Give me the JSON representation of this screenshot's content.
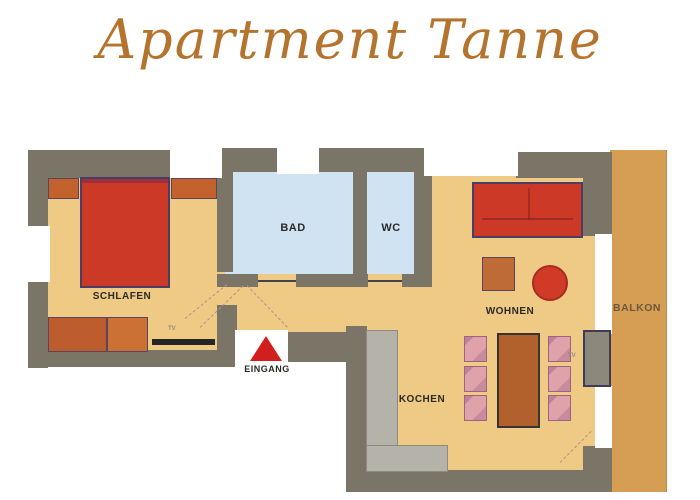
{
  "title": "Apartment Tanne",
  "floorplan": {
    "rooms": {
      "schlafen": "SCHLAFEN",
      "bad": "BAD",
      "wc": "WC",
      "wohnen": "WOHNEN",
      "kochen": "KOCHEN",
      "balkon": "BALKON"
    },
    "entrance_label": "EINGANG",
    "tv_bedroom": "TV",
    "tv_living": "TV"
  },
  "colors": {
    "title_text": "#b5742e",
    "wall": "#7b7568",
    "floor": "#eeca85",
    "balcony_floor": "#d69d55",
    "bath_floor": "#cfe3f2",
    "furniture_red": "#cc3a27",
    "furniture_orange": "#c4622d",
    "dining_table_brown": "#b2612c",
    "chair_pink": "#dfa2ab",
    "kitchen_counter_gray": "#b5b2a9",
    "entrance_marker_red": "#d11f1d",
    "label_text": "#2b2a26"
  }
}
